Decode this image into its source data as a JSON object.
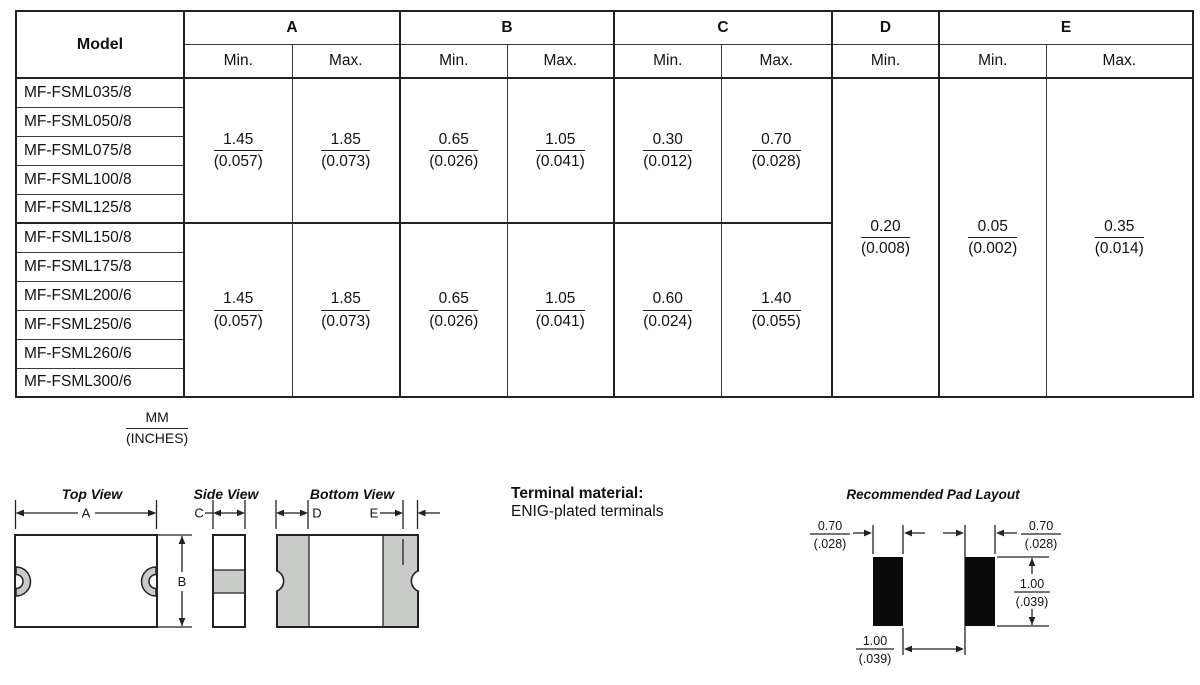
{
  "table": {
    "header": {
      "model": "Model",
      "groups": [
        {
          "label": "A",
          "subs": [
            "Min.",
            "Max."
          ]
        },
        {
          "label": "B",
          "subs": [
            "Min.",
            "Max."
          ]
        },
        {
          "label": "C",
          "subs": [
            "Min.",
            "Max."
          ]
        },
        {
          "label": "D",
          "subs": [
            "Min."
          ]
        },
        {
          "label": "E",
          "subs": [
            "Min.",
            "Max."
          ]
        }
      ]
    },
    "row_groups": [
      {
        "models": [
          "MF-FSML035/8",
          "MF-FSML050/8",
          "MF-FSML075/8",
          "MF-FSML100/8",
          "MF-FSML125/8"
        ],
        "dims": {
          "a_min": {
            "mm": "1.45",
            "in": "(0.057)"
          },
          "a_max": {
            "mm": "1.85",
            "in": "(0.073)"
          },
          "b_min": {
            "mm": "0.65",
            "in": "(0.026)"
          },
          "b_max": {
            "mm": "1.05",
            "in": "(0.041)"
          },
          "c_min": {
            "mm": "0.30",
            "in": "(0.012)"
          },
          "c_max": {
            "mm": "0.70",
            "in": "(0.028)"
          }
        }
      },
      {
        "models": [
          "MF-FSML150/8",
          "MF-FSML175/8",
          "MF-FSML200/6",
          "MF-FSML250/6",
          "MF-FSML260/6",
          "MF-FSML300/6"
        ],
        "dims": {
          "a_min": {
            "mm": "1.45",
            "in": "(0.057)"
          },
          "a_max": {
            "mm": "1.85",
            "in": "(0.073)"
          },
          "b_min": {
            "mm": "0.65",
            "in": "(0.026)"
          },
          "b_max": {
            "mm": "1.05",
            "in": "(0.041)"
          },
          "c_min": {
            "mm": "0.60",
            "in": "(0.024)"
          },
          "c_max": {
            "mm": "1.40",
            "in": "(0.055)"
          }
        }
      }
    ],
    "shared_dims": {
      "d_min": {
        "mm": "0.20",
        "in": "(0.008)"
      },
      "e_min": {
        "mm": "0.05",
        "in": "(0.002)"
      },
      "e_max": {
        "mm": "0.35",
        "in": "(0.014)"
      }
    }
  },
  "units_note": {
    "top": "MM",
    "bottom": "(INCHES)"
  },
  "drawings": {
    "top_view": {
      "title": "Top View",
      "dim_a": "A",
      "dim_b": "B"
    },
    "side_view": {
      "title": "Side View",
      "dim_c": "C"
    },
    "bottom_view": {
      "title": "Bottom View",
      "dim_d": "D",
      "dim_e": "E"
    },
    "terminal_material": {
      "heading": "Terminal material:",
      "text": "ENIG-plated terminals"
    },
    "pad_layout": {
      "title": "Recommended Pad Layout",
      "pad_width_left": {
        "mm": "0.70",
        "in": "(.028)"
      },
      "pad_width_right": {
        "mm": "0.70",
        "in": "(.028)"
      },
      "pad_height": {
        "mm": "1.00",
        "in": "(.039)"
      },
      "pad_gap": {
        "mm": "1.00",
        "in": "(.039)"
      }
    }
  },
  "colors": {
    "line": "#222222",
    "gray_fill": "#c9cbc9",
    "pad_black": "#0a0a0a"
  }
}
